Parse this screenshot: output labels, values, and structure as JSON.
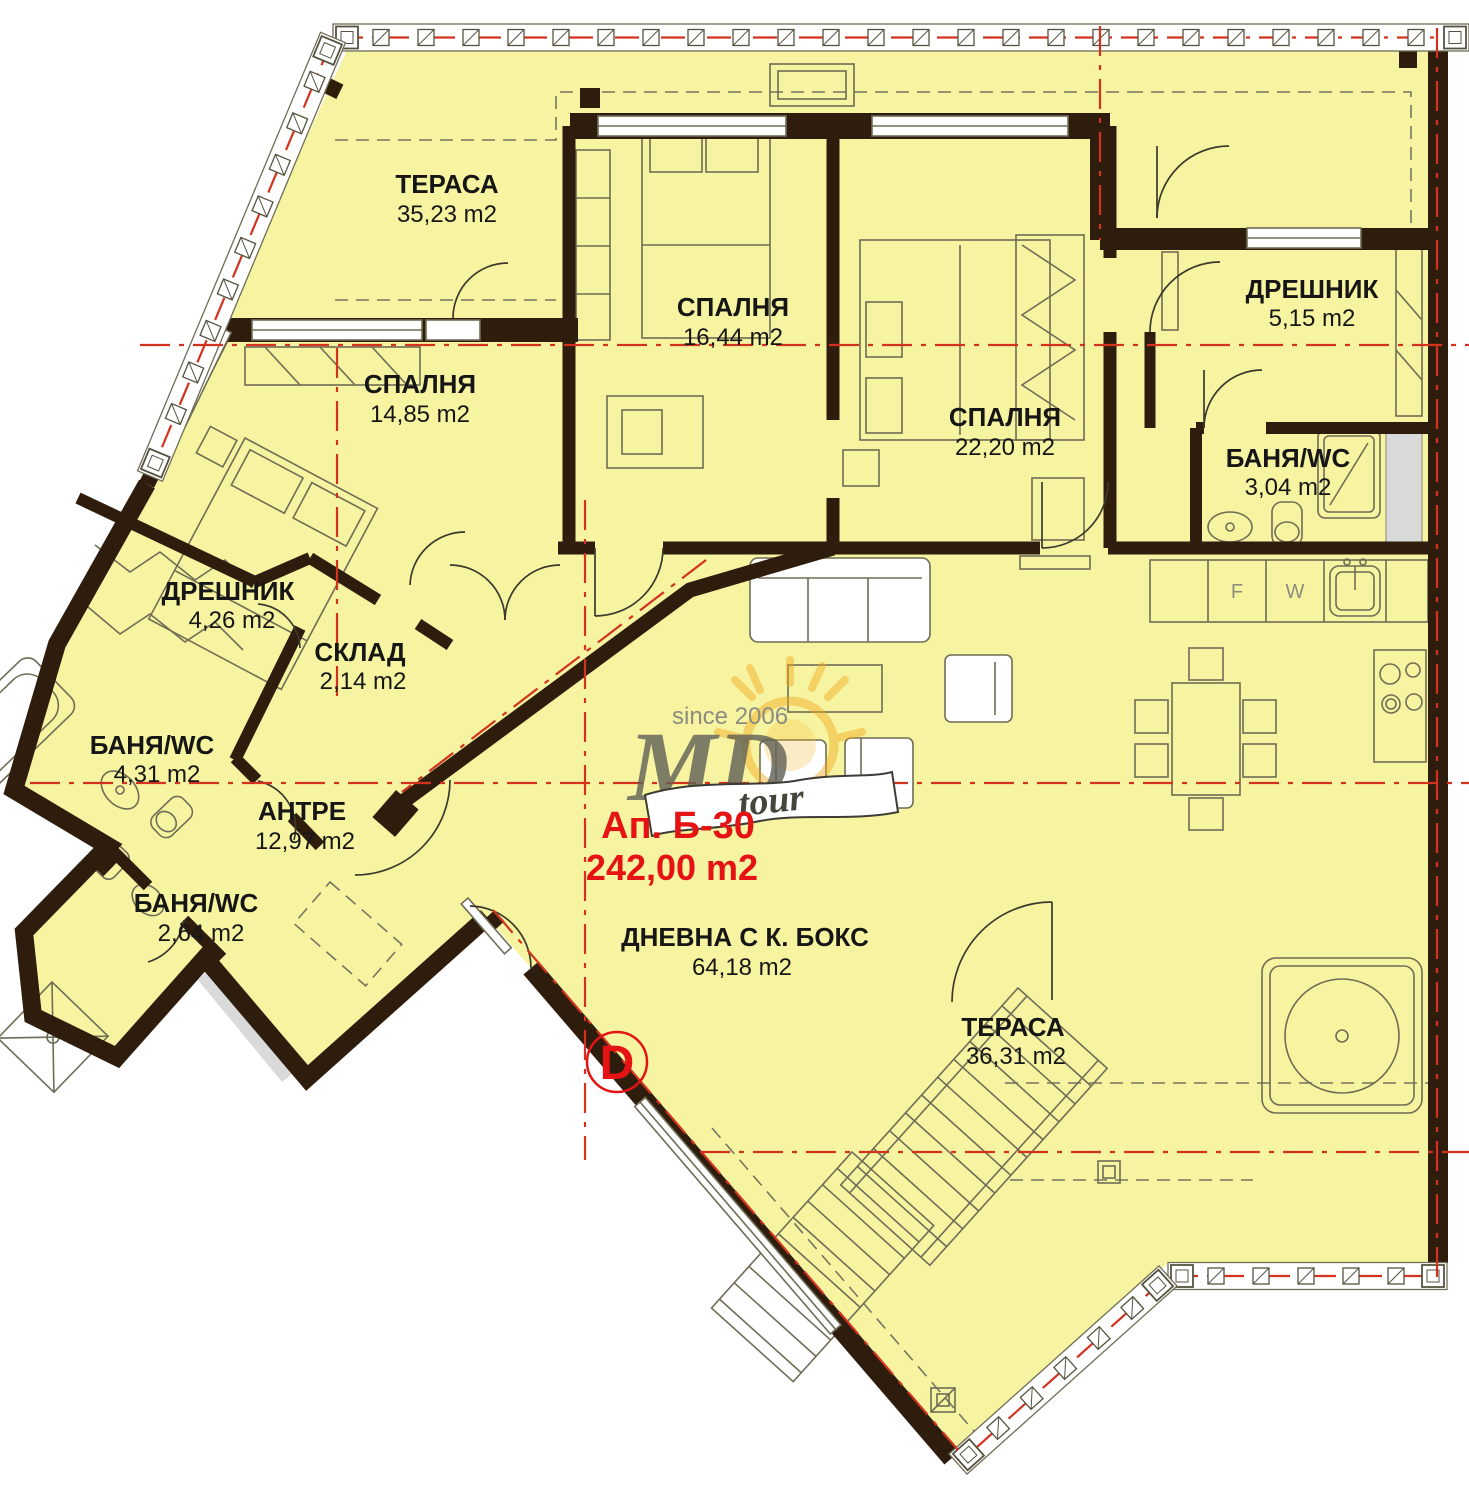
{
  "apartment": {
    "label": "Ап. Б-30",
    "total_area": "242,00 m2"
  },
  "marker": {
    "letter": "D"
  },
  "branding": {
    "since": "since 2006",
    "brand": "MD",
    "suffix": "tour"
  },
  "kitchen": {
    "fridge_label": "F",
    "washer_label": "W"
  },
  "rooms": [
    {
      "name": "ТЕРАСА",
      "area": "35,23 m2"
    },
    {
      "name": "СПАЛНЯ",
      "area": "16,44 m2"
    },
    {
      "name": "СПАЛНЯ",
      "area": "22,20 m2"
    },
    {
      "name": "СПАЛНЯ",
      "area": "14,85 m2"
    },
    {
      "name": "ДРЕШНИК",
      "area": "5,15 m2"
    },
    {
      "name": "БАНЯ/WC",
      "area": "3,04 m2"
    },
    {
      "name": "ДРЕШНИК",
      "area": "4,26 m2"
    },
    {
      "name": "СКЛАД",
      "area": "2,14 m2"
    },
    {
      "name": "БАНЯ/WC",
      "area": "4,31 m2"
    },
    {
      "name": "АНТРЕ",
      "area": "12,97 m2"
    },
    {
      "name": "БАНЯ/WC",
      "area": "2,64 m2"
    },
    {
      "name": "ДНЕВНА С К. БОКС",
      "area": "64,18 m2"
    },
    {
      "name": "ТЕРАСА",
      "area": "36,31 m2"
    }
  ],
  "colors": {
    "floor_fill": "#f7f4a1",
    "wall": "#2e1d0d",
    "axis_red": "#d2321e",
    "label_red": "#e51313",
    "sun_orange": "#f2a81d"
  }
}
